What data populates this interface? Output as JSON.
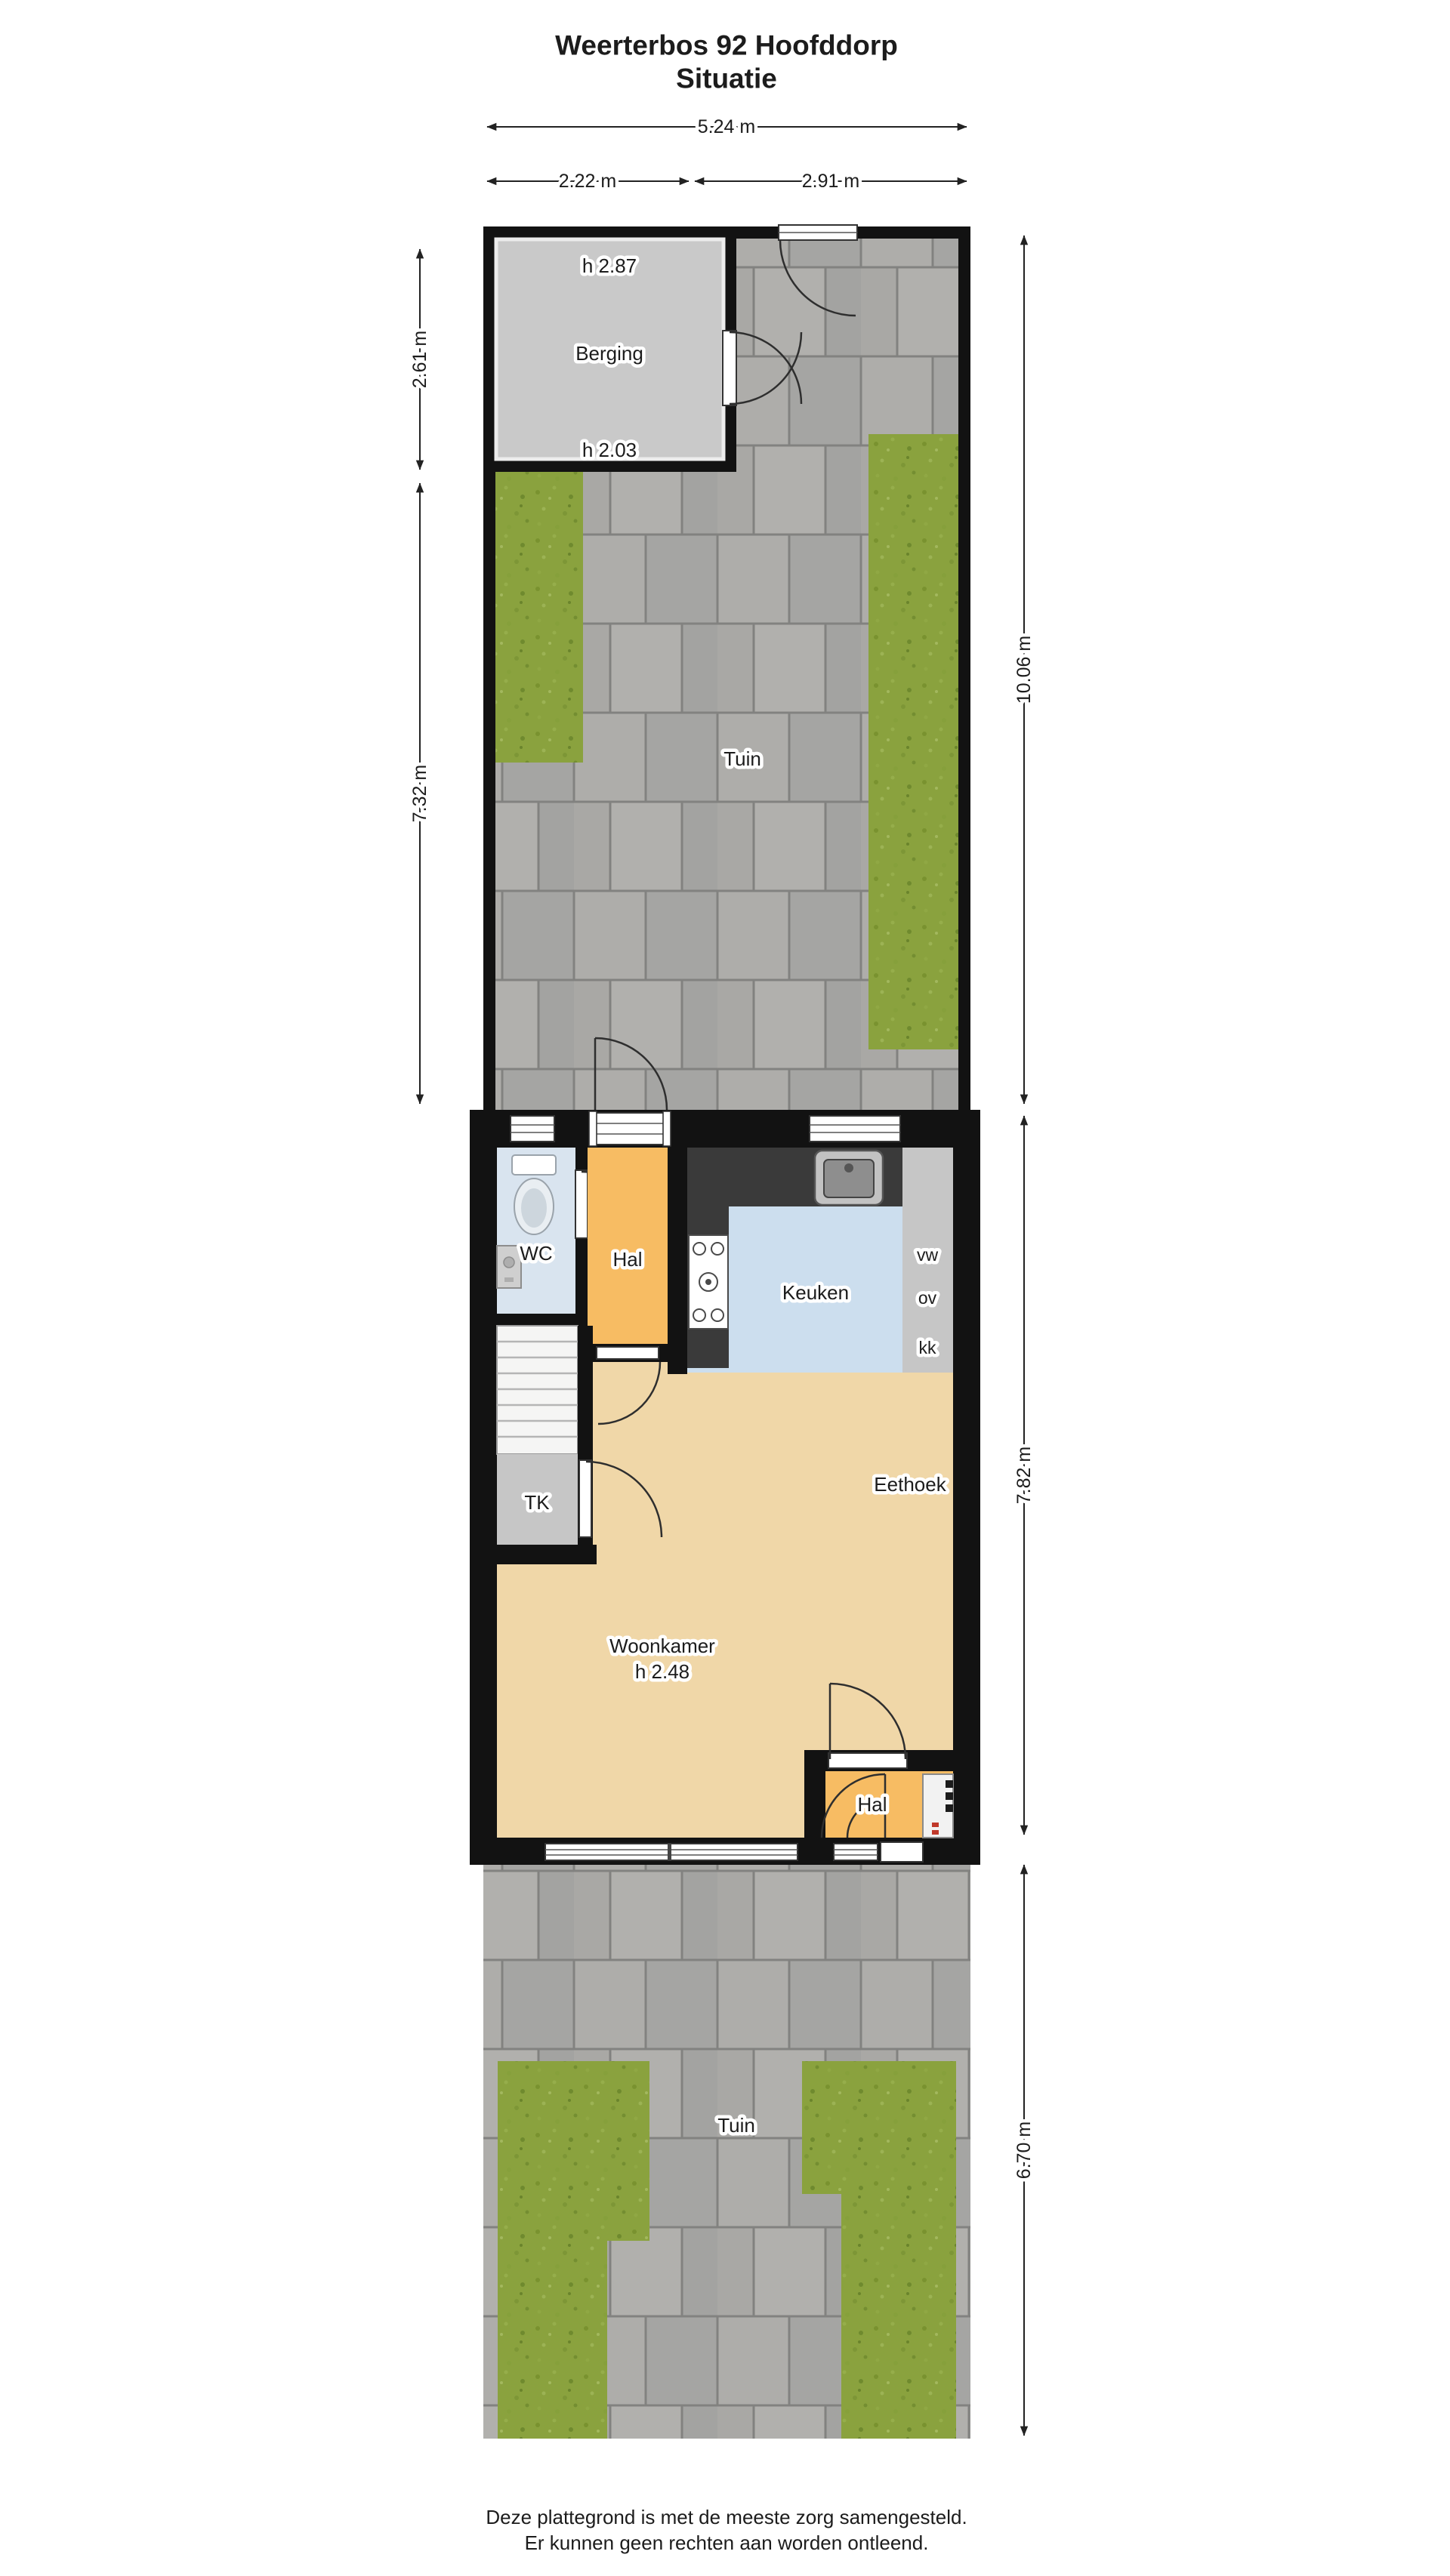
{
  "title": {
    "line1": "Weerterbos 92 Hoofddorp",
    "line2": "Situatie"
  },
  "dimensions": {
    "top_total": "5.24 m",
    "top_left": "2.22 m",
    "top_right": "2.91 m",
    "left_berging": "2.61 m",
    "left_garden": "7.32 m",
    "right_back_garden": "10.06 m",
    "right_house": "7.82 m",
    "right_front_garden": "6.70 m"
  },
  "back_garden": {
    "label": "Tuin",
    "berging": {
      "label": "Berging",
      "height_top": "h 2.87",
      "height_bottom": "h 2.03"
    }
  },
  "house": {
    "wc": {
      "label": "WC"
    },
    "hall_upper": {
      "label": "Hal"
    },
    "kitchen": {
      "label": "Keuken",
      "appliances": {
        "dishwasher": "vw",
        "oven": "ov",
        "fridge": "kk"
      }
    },
    "closet": {
      "label": "TK"
    },
    "dining": {
      "label": "Eethoek"
    },
    "living": {
      "label": "Woonkamer",
      "height": "h 2.48"
    },
    "hall_lower": {
      "label": "Hal"
    }
  },
  "front_garden": {
    "label": "Tuin"
  },
  "footer": {
    "line1": "Deze plattegrond is met de meeste zorg samengesteld.",
    "line2": "Er kunnen geen rechten aan worden ontleend."
  },
  "colors": {
    "wall": "#121212",
    "paving": "#a8a8a6",
    "grass": "#8aa23e",
    "hall_floor": "#f7bc63",
    "kitchen_floor": "#ccdeee",
    "living_floor": "#f0d7a8",
    "storage_floor": "#c9c9c9",
    "wc_floor": "#d9e4ef",
    "counter": "#3a3a3a"
  }
}
